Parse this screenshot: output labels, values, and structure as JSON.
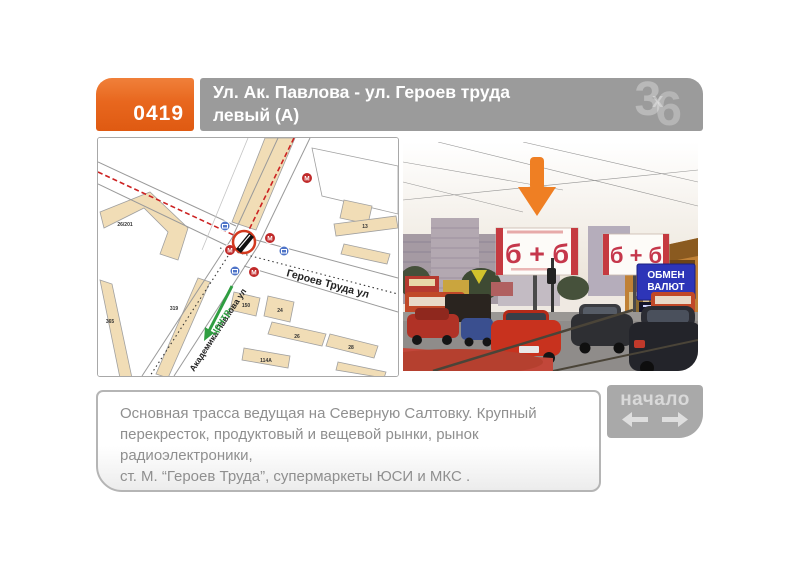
{
  "header": {
    "code": "0419",
    "title_line1": "Ул. Ак. Павлова - ул. Героев труда",
    "title_line2": "левый (А)",
    "logo_3": "3",
    "logo_x": "х",
    "logo_6": "6",
    "accent_color": "#e8671e",
    "bar_color": "#9b9b9b"
  },
  "map": {
    "street_geroev": "Героев Труда ул",
    "street_pavlova": "Академика Павлова ул",
    "route_center": "центр-",
    "metro_letter": "М",
    "buildings": [
      "26/201",
      "319",
      "365",
      "13",
      "150",
      "24",
      "26",
      "28",
      "114А"
    ],
    "route_color": "#cc2222",
    "center_color": "#2f9e41",
    "building_fill": "#f1ddb6"
  },
  "photo": {
    "billboard_ad": "б + б",
    "exchange_line1": "ОБМЕН",
    "exchange_line2": "ВАЛЮТ",
    "arrow_color": "#ef7f23"
  },
  "description": {
    "lines": [
      "Основная трасса ведущая  на Северную Салтовку. Крупный",
      "перекресток, продуктовый и вещевой рынки, рынок радиоэлектроники,",
      "ст. М. “Героев Труда”, супермаркеты ЮСИ и МКС ."
    ]
  },
  "pager": {
    "label": "начало"
  }
}
